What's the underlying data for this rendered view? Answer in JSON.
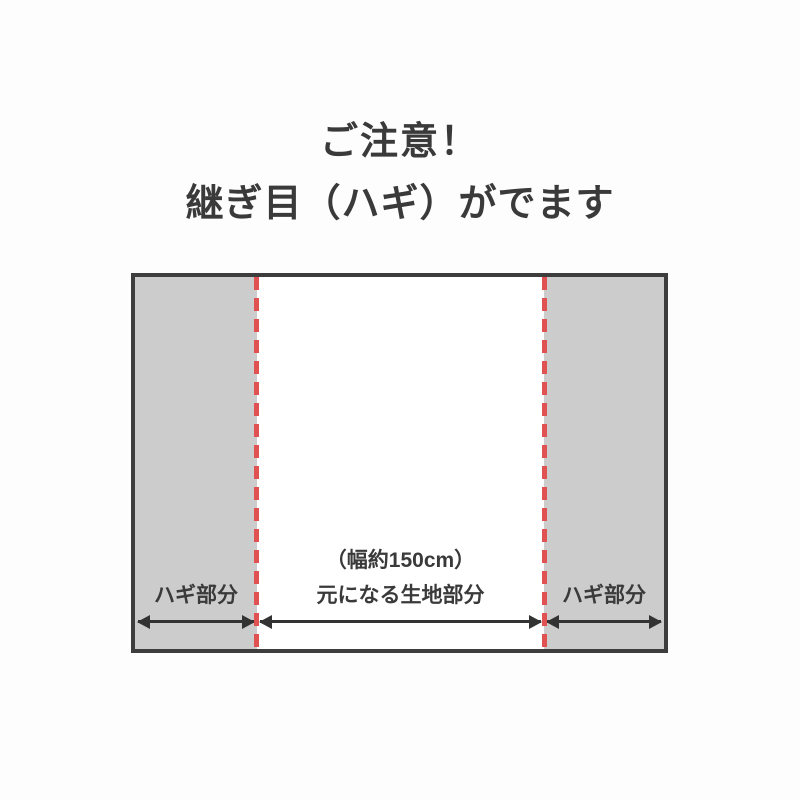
{
  "title": {
    "line1": "ご注意！",
    "line2": "継ぎ目（ハギ）がでます"
  },
  "diagram": {
    "left_panel": {
      "label": "ハギ部分"
    },
    "center_panel": {
      "width_note": "（幅約150cm）",
      "label": "元になる生地部分"
    },
    "right_panel": {
      "label": "ハギ部分"
    },
    "colors": {
      "panel_gray": "#cccccc",
      "seam_red": "#e05252",
      "border_dark": "#3d3d3d",
      "arrow_dark": "#333333",
      "text_dark": "#3a3a3a"
    }
  }
}
